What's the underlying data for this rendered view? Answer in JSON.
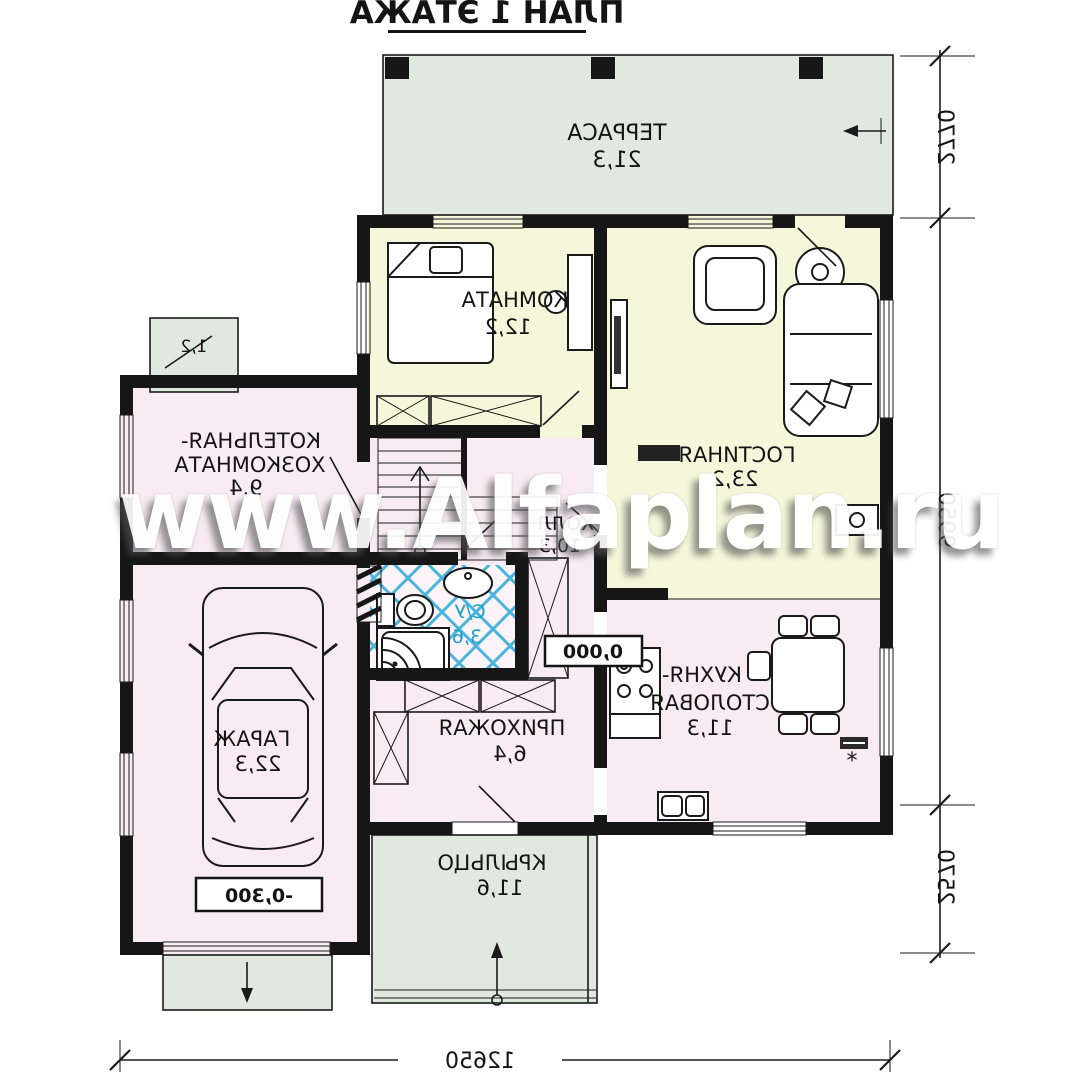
{
  "title": "ПЛАН 1 ЭТАЖА",
  "watermark": "www.Alfaplan.ru",
  "rooms": {
    "terrace": {
      "name": "ТЕРРАСА",
      "area": "21,3"
    },
    "bedroom": {
      "name": "КОМНАТА",
      "area": "12,2"
    },
    "living": {
      "name": "ГОСТИНАЯ",
      "area": "23,2"
    },
    "boiler": {
      "name_line1": "КОТЕЛЬНАЯ-",
      "name_line2": "ХОЗКОМНАТА",
      "area": "9,4"
    },
    "garage": {
      "name": "ГАРАЖ",
      "area": "22,3"
    },
    "hall": {
      "name": "ХОЛЛ",
      "area": "10,3"
    },
    "bathroom": {
      "name": "С/У",
      "area": "3,6"
    },
    "hallway": {
      "name": "ПРИХОЖАЯ",
      "area": "6,4"
    },
    "kitchen": {
      "name_line1": "КУХНЯ-",
      "name_line2": "СТОЛОВАЯ",
      "area": "11,3"
    },
    "porch": {
      "name": "КРЫЛЬЦО",
      "area": "11,6"
    },
    "stoop": {
      "area": "1,2"
    }
  },
  "levels": {
    "main": "0,000",
    "garage": "-0,300"
  },
  "dimensions": {
    "right": [
      "2770",
      "9950",
      "2570"
    ],
    "bottom": "12650"
  },
  "marks": {
    "star": "*"
  },
  "colors": {
    "wall": "#161616",
    "room_yellow": "#f6f6da",
    "room_pink": "#f8ebf3",
    "outdoor_green": "#dfe9df",
    "tile_blue": "#2aa9d4",
    "bath_bg": "#fdf4f9",
    "watermark": "#ffffff"
  }
}
